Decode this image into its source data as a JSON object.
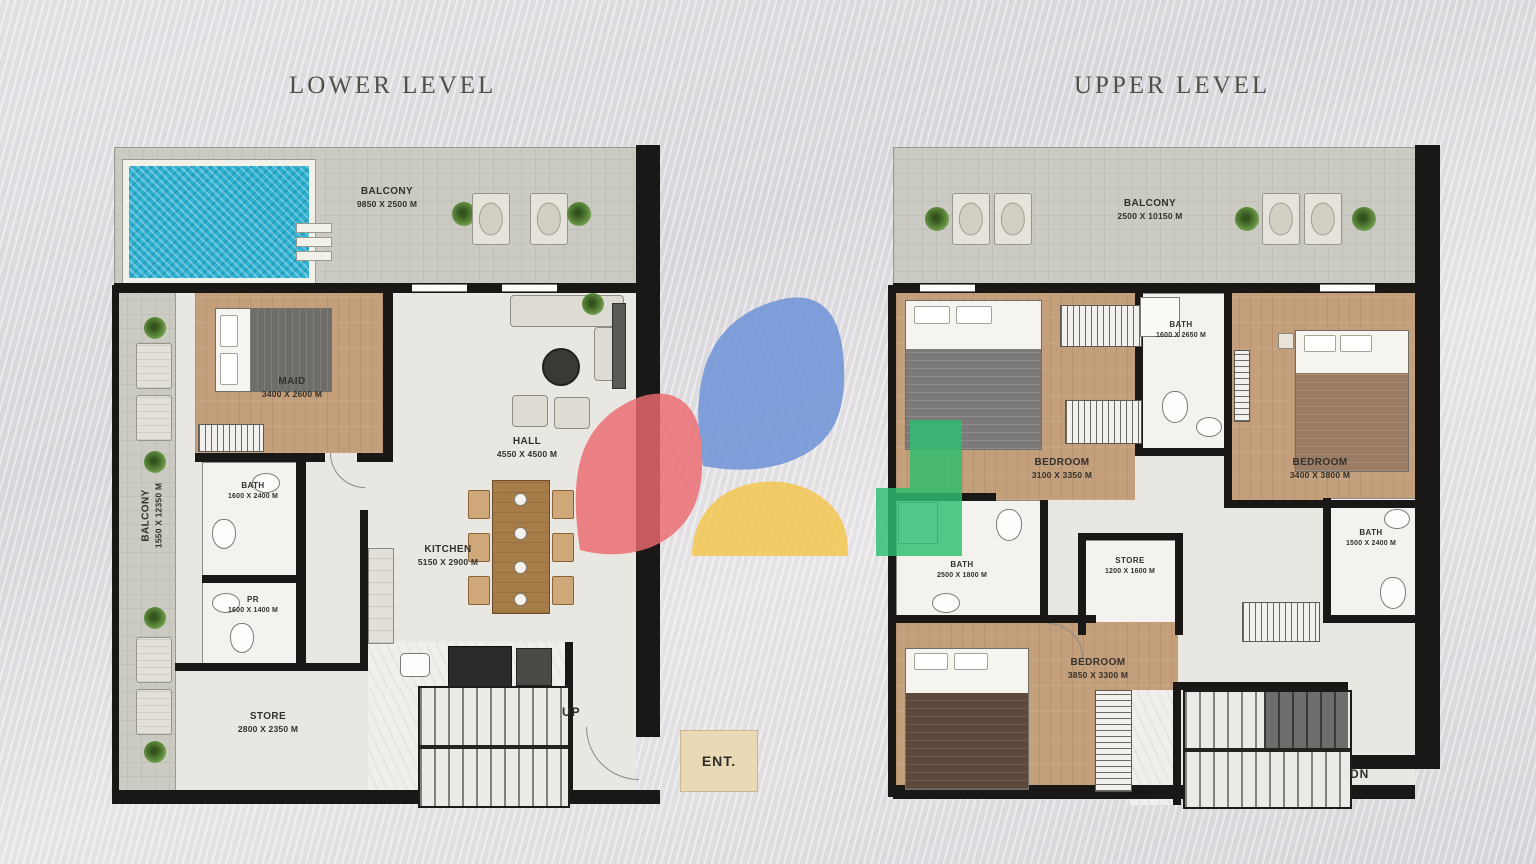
{
  "lower_level": {
    "title": "LOWER LEVEL",
    "balcony_top": {
      "name": "BALCONY",
      "dims": "9850 X 2500 M"
    },
    "balcony_side": {
      "name": "BALCONY",
      "dims": "1550 X 12350 M"
    },
    "rooms": [
      {
        "name": "MAID",
        "dims": "3400 X 2600 M"
      },
      {
        "name": "HALL",
        "dims": "4550 X 4500 M"
      },
      {
        "name": "BATH",
        "dims": "1600 X 2400 M"
      },
      {
        "name": "PR",
        "dims": "1600 X 1400 M"
      },
      {
        "name": "KITCHEN",
        "dims": "5150 X 2900 M"
      },
      {
        "name": "STORE",
        "dims": "2800 X 2350 M"
      }
    ],
    "markers": {
      "up": "UP",
      "entrance": "ENT."
    }
  },
  "upper_level": {
    "title": "UPPER LEVEL",
    "balcony_top": {
      "name": "BALCONY",
      "dims": "2500 X 10150 M"
    },
    "rooms": [
      {
        "name": "BATH",
        "dims": "1600 X 2650 M"
      },
      {
        "name": "BEDROOM",
        "dims": "3100 X 3350 M"
      },
      {
        "name": "BEDROOM",
        "dims": "3400 X 3800 M"
      },
      {
        "name": "BATH",
        "dims": "2500 X 1800 M"
      },
      {
        "name": "STORE",
        "dims": "1200 X 1600 M"
      },
      {
        "name": "BATH",
        "dims": "1500 X 2400 M"
      },
      {
        "name": "BEDROOM",
        "dims": "3850 X 3300 M"
      }
    ],
    "markers": {
      "down": "DN"
    }
  },
  "watermark": {
    "colors": {
      "blue": "#6a8fd6",
      "red": "#ec6a70",
      "yellow": "#f4c64b",
      "green": "#2fbf71"
    }
  },
  "palette": {
    "wall": "#191816",
    "pool": "#2eb3d2",
    "wood_floor": "#c49f7c",
    "concrete": "#cbcbc3",
    "background": "#e3e1e4",
    "entrance_pad": "#e9d9b6"
  }
}
